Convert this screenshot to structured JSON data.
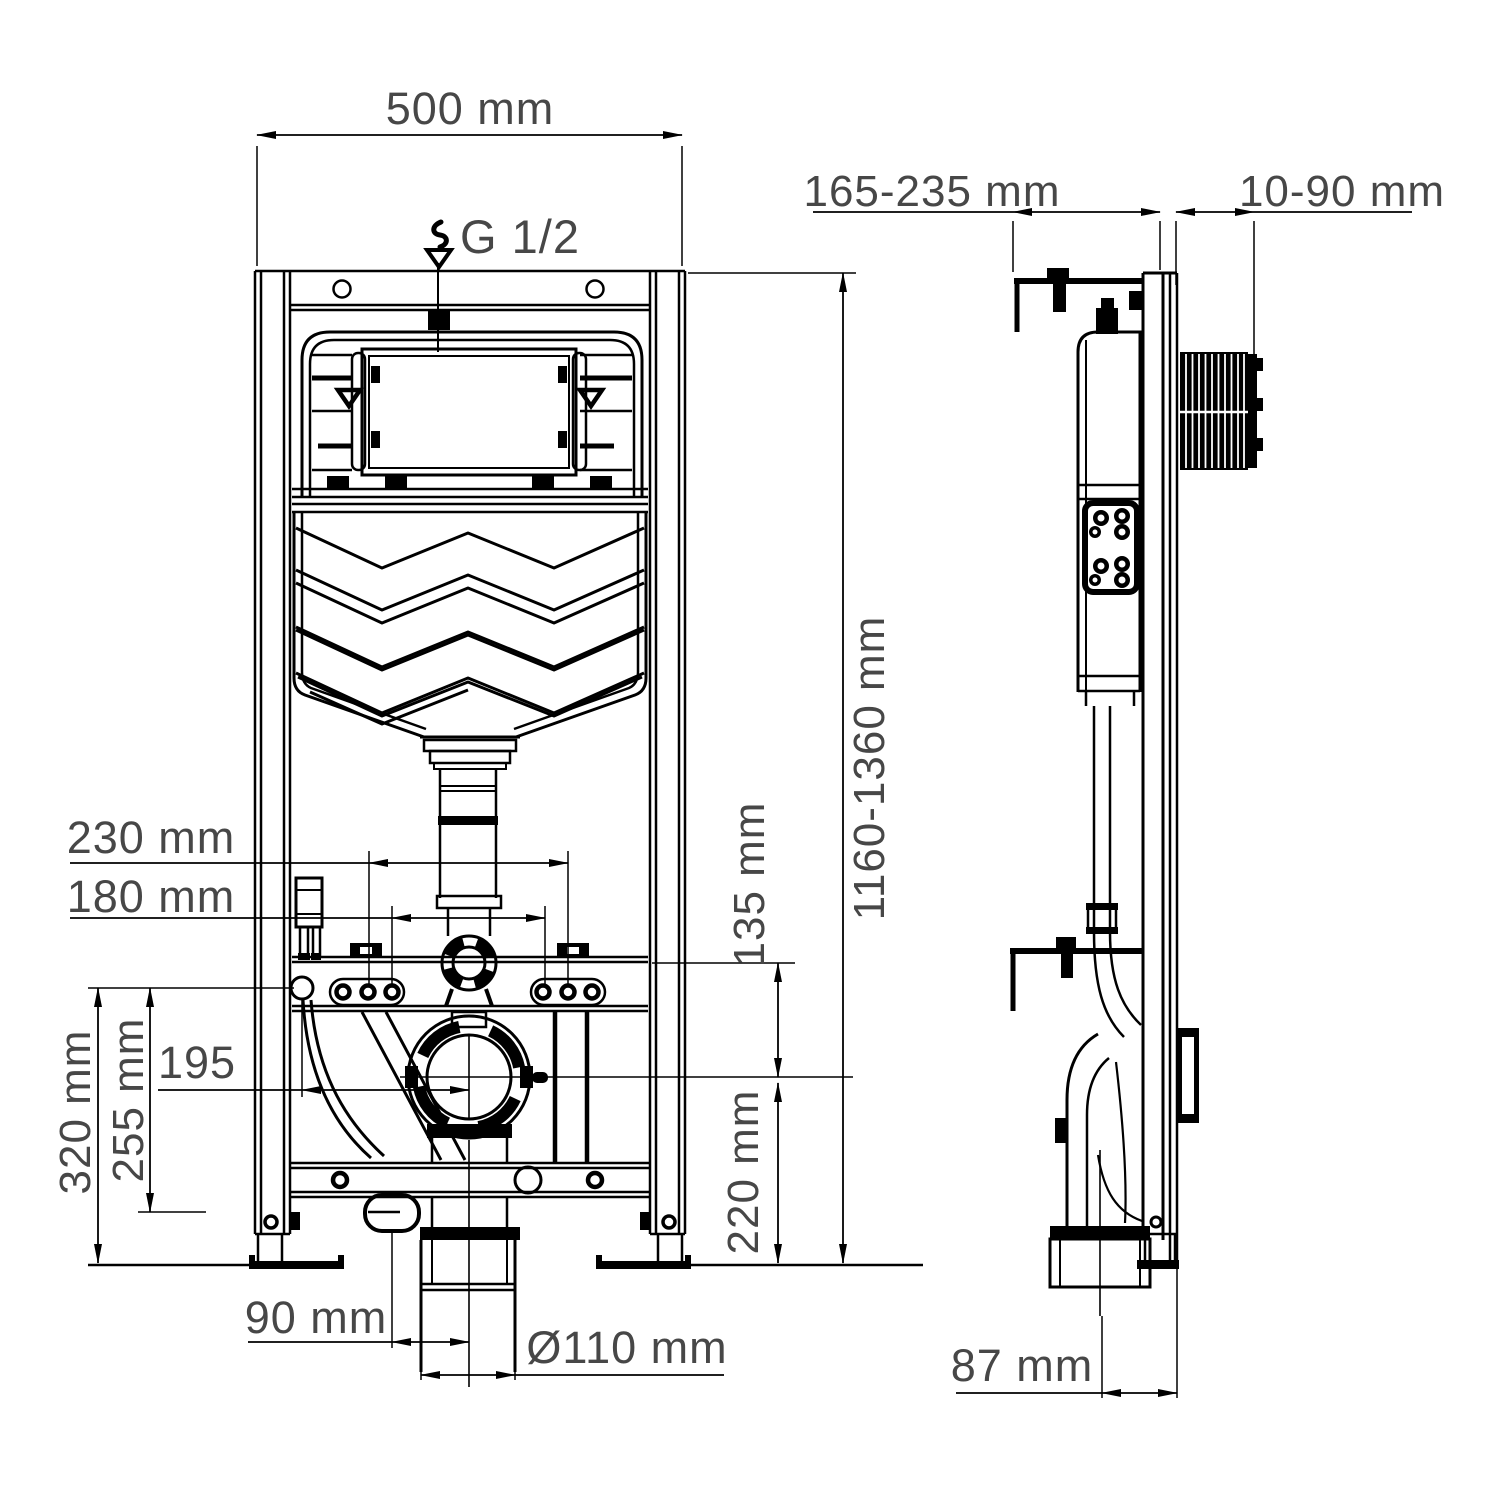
{
  "drawing": {
    "type": "technical-installation-diagram",
    "subject": "wall-mounted concealed WC cistern frame, front and side views",
    "colors": {
      "line": "#000000",
      "text": "#474747",
      "background": "#ffffff"
    }
  },
  "front_view": {
    "labels": {
      "frame_width": "500 mm",
      "water_inlet_thread": "G 1/2",
      "frame_height_range": "1160-1360 mm",
      "fixing_span_outer": "230 mm",
      "fixing_span_inner": "180 mm",
      "flush_to_drain_drop": "135 mm",
      "inlet_to_drain_offset": "195",
      "inlet_height_mid": "255 mm",
      "inlet_height_full": "320 mm",
      "drain_center_height": "220 mm",
      "drain_horizontal_offset": "90 mm",
      "drain_pipe_diameter": "Ø110 mm"
    }
  },
  "side_view": {
    "labels": {
      "frame_depth_range": "165-235 mm",
      "wall_facing_range": "10-90 mm",
      "drain_wall_offset": "87 mm"
    }
  }
}
